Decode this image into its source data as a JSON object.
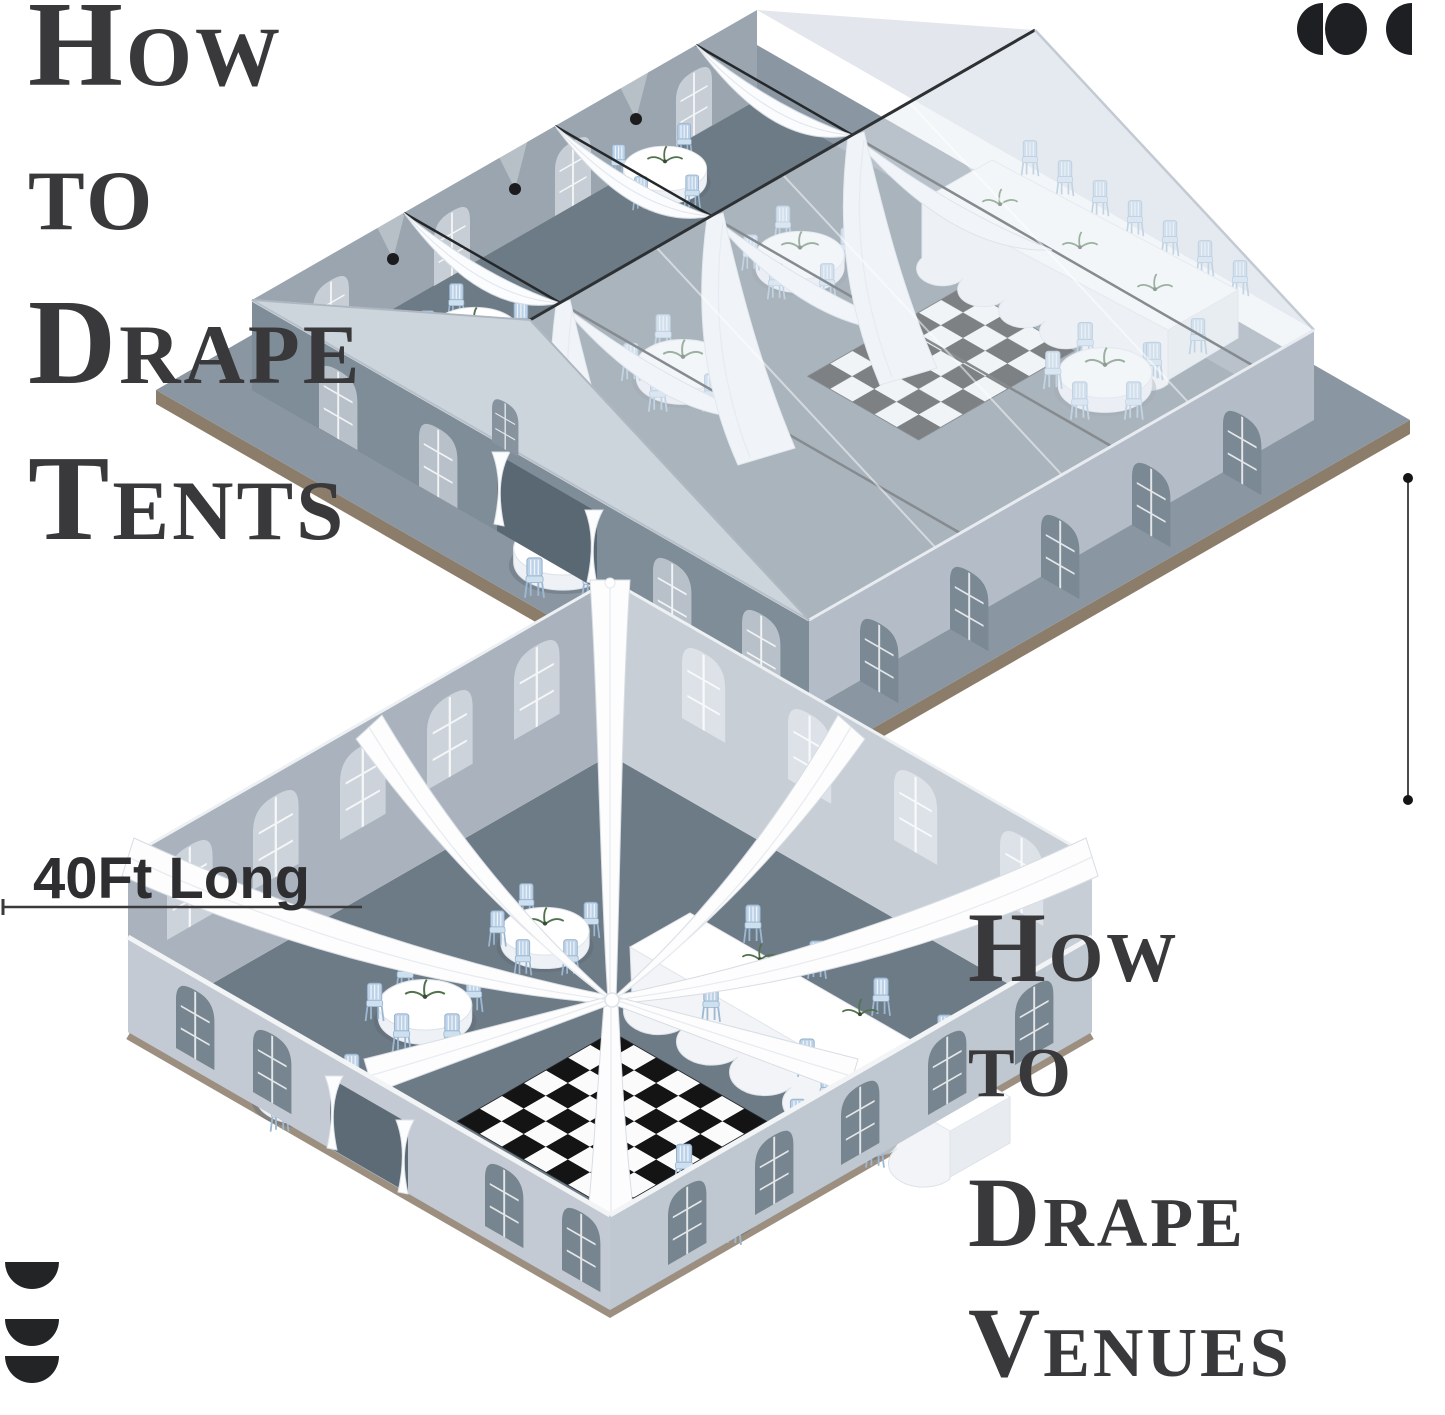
{
  "titles": {
    "tents": {
      "lines": [
        "How",
        "to",
        "Drape",
        "Tents"
      ]
    },
    "venues": {
      "lines": [
        "How",
        "to",
        "Drape",
        "Venues"
      ]
    }
  },
  "dimensions": {
    "length_label": "40Ft Long"
  },
  "icons": {
    "top_right": "logo-three-moons-icon",
    "bottom_left": "logo-three-half-discs-icon"
  },
  "colors": {
    "title_text": "#39393b",
    "label_text": "#2e2e30",
    "icon": "#1e1f22",
    "floor": "#6d7b86",
    "wall_interior": "#9aa5af",
    "wall_exterior_light": "#b4bdc7",
    "wall_exterior_dark": "#7f8d98",
    "roof": "#e8edf3",
    "drape": "#fcfdfe",
    "chair": "#bcd2e8",
    "tablecloth": "#ffffff",
    "platform_edge": "#8b7b69",
    "checker_dark": "#141414",
    "checker_light": "#fbfbfb",
    "cable": "#24282b"
  }
}
